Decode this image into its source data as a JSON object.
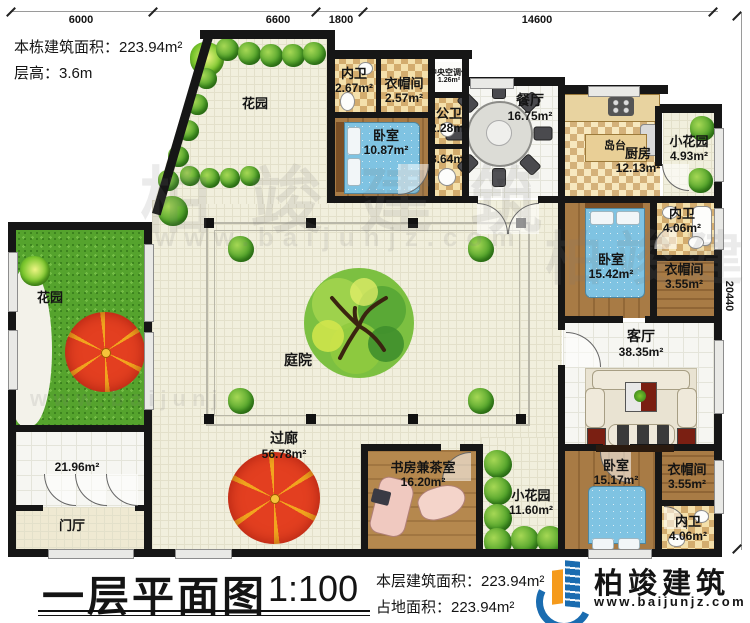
{
  "header": {
    "building_area": "本栋建筑面积：223.94m²",
    "floor_height": "层高：3.6m"
  },
  "dimensions": {
    "top": [
      "6000",
      "6600",
      "1800",
      "14600"
    ],
    "right": "20440"
  },
  "rooms": [
    {
      "name": "花园",
      "area": ""
    },
    {
      "name": "内卫",
      "area": "2.67m²"
    },
    {
      "name": "衣帽间",
      "area": "2.57m²"
    },
    {
      "name": "中央空调位",
      "area": "1.26m²"
    },
    {
      "name": "卧室",
      "area": "10.87m²"
    },
    {
      "name": "公卫",
      "area": "2.28m²"
    },
    {
      "name": "",
      "area": "3.64m²"
    },
    {
      "name": "餐厅",
      "area": "16.75m²"
    },
    {
      "name": "岛台",
      "area": ""
    },
    {
      "name": "厨房",
      "area": "12.13m²"
    },
    {
      "name": "小花园",
      "area": "4.93m²"
    },
    {
      "name": "内卫",
      "area": "4.06m²"
    },
    {
      "name": "卧室",
      "area": "15.42m²"
    },
    {
      "name": "衣帽间",
      "area": "3.55m²"
    },
    {
      "name": "客厅",
      "area": "38.35m²"
    },
    {
      "name": "花园",
      "area": ""
    },
    {
      "name": "",
      "area": "21.96m²"
    },
    {
      "name": "门厅",
      "area": ""
    },
    {
      "name": "庭院",
      "area": ""
    },
    {
      "name": "过廊",
      "area": "56.78m²"
    },
    {
      "name": "书房兼茶室",
      "area": "16.20m²"
    },
    {
      "name": "小花园",
      "area": "11.60m²"
    },
    {
      "name": "卧室",
      "area": "15.17m²"
    },
    {
      "name": "衣帽间",
      "area": "3.55m²"
    },
    {
      "name": "内卫",
      "area": "4.06m²"
    }
  ],
  "footer": {
    "title": "一层平面图",
    "scale": "1:100",
    "floor_area": "本层建筑面积：223.94m²",
    "land_area": "占地面积：223.94m²",
    "brand": "柏竣建筑",
    "website": "www.baijunjz.com"
  },
  "watermark": {
    "brand": "柏竣建筑",
    "website": "www.baijunjz.com"
  }
}
